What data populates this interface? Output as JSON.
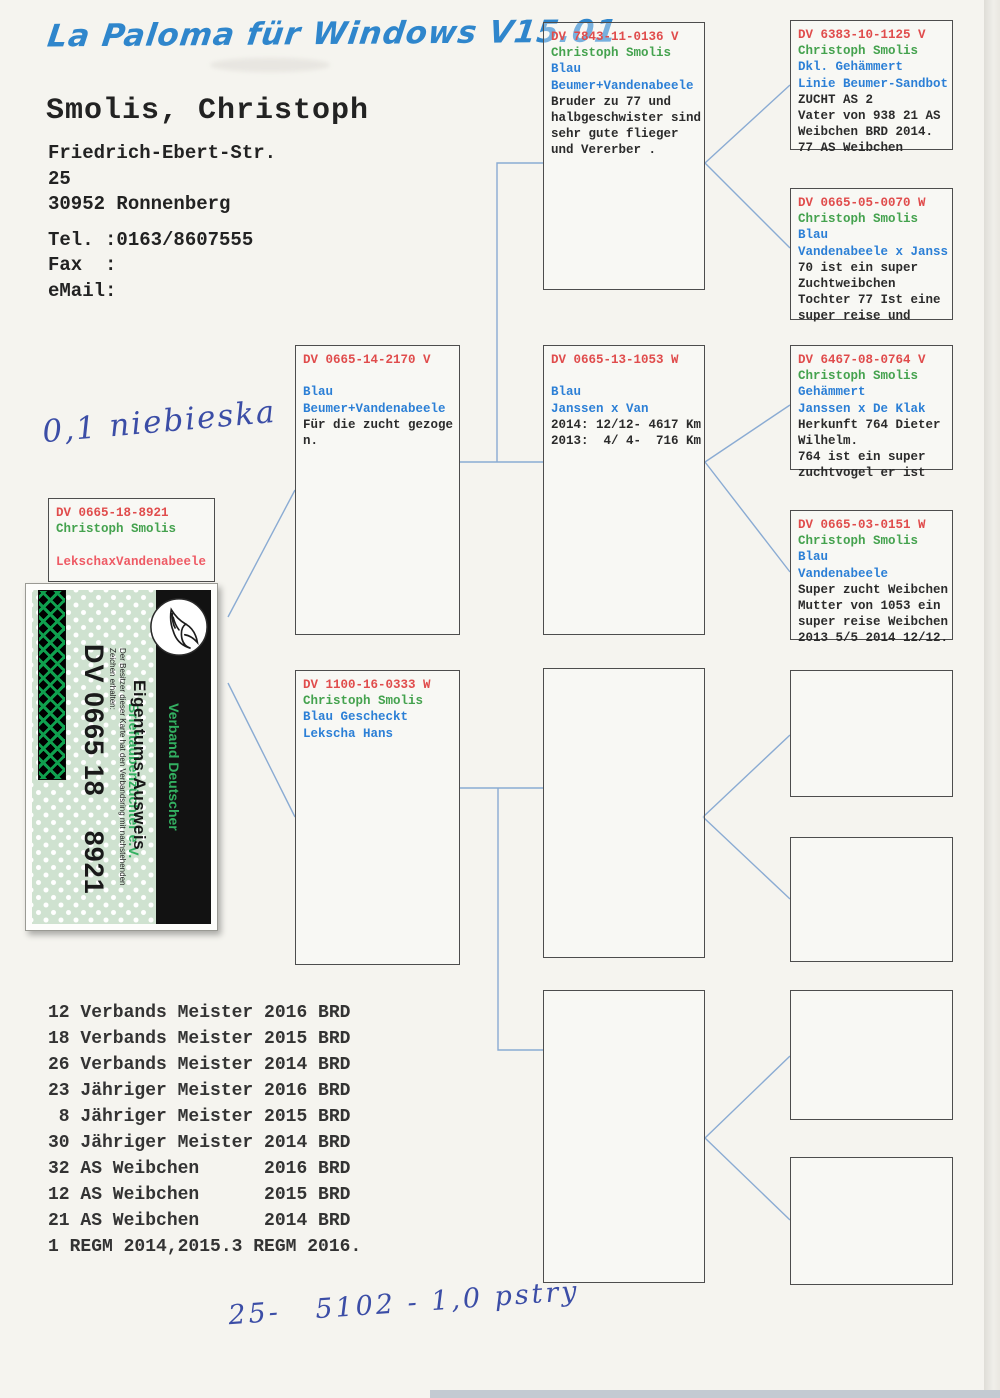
{
  "header": {
    "software": "La Paloma für Windows V15.01",
    "owner_name": "Smolis, Christoph",
    "address_lines": [
      "Friedrich-Ebert-Str.",
      "25",
      "30952 Ronnenberg"
    ],
    "contact_lines": [
      "Tel. :0163/8607555",
      "Fax  :",
      "eMail:"
    ]
  },
  "handwriting": {
    "top_note": "0,1 niebieska",
    "bottom_note": "25-   5102 - 1,0 pstry"
  },
  "subject": {
    "ring": "DV 0665-18-8921",
    "breeder": "Christoph Smolis",
    "strain": "LekschaxVandenabeele"
  },
  "card": {
    "org_line1": "Verband Deutscher",
    "org_line2": "Brieftaubenzüchter e.V.",
    "title": "Eigentums-Ausweis",
    "subtext": "Der Besitzer dieser Karte hat den Verbandsring mit nachstehenden Zeichen erhalten:",
    "ring_number": "DV 0665 18    8921",
    "logo_icon": "dove-logo"
  },
  "pedigree": {
    "boxes": [
      {
        "key": "sire",
        "ring": "DV 0665-14-2170 V",
        "breeder": "",
        "color_lines": [
          "Blau",
          "Beumer+Vandenabeele"
        ],
        "notes": [
          "Für die zucht gezoge",
          "n."
        ]
      },
      {
        "key": "dam",
        "ring": "DV 1100-16-0333 W",
        "breeder": "Christoph Smolis",
        "color_lines": [
          "Blau Gescheckt",
          "Lekscha Hans"
        ],
        "notes": []
      },
      {
        "key": "ss",
        "ring": "DV 7843-11-0136 V",
        "breeder": "Christoph Smolis",
        "color_lines": [
          "Blau",
          "Beumer+Vandenabeele"
        ],
        "notes": [
          "Bruder zu 77 und",
          "halbgeschwister sind",
          "sehr gute flieger",
          "und Vererber ."
        ]
      },
      {
        "key": "sd",
        "ring": "DV 0665-13-1053 W",
        "breeder": "",
        "color_lines": [
          "Blau",
          "Janssen x Van"
        ],
        "notes": [
          "2014: 12/12- 4617 Km",
          "2013:  4/ 4-  716 Km"
        ]
      },
      {
        "key": "ds"
      },
      {
        "key": "dd"
      },
      {
        "key": "sss",
        "ring": "DV 6383-10-1125 V",
        "breeder": "Christoph Smolis",
        "color_lines": [
          "Dkl. Gehämmert",
          "Linie Beumer-Sandbot"
        ],
        "notes": [
          "ZUCHT AS 2",
          "Vater von 938 21 AS",
          "Weibchen BRD 2014.",
          "77 AS Weibchen"
        ]
      },
      {
        "key": "ssd",
        "ring": "DV 0665-05-0070 W",
        "breeder": "Christoph Smolis",
        "color_lines": [
          "Blau",
          "Vandenabeele x Janss"
        ],
        "notes": [
          "70 ist ein super",
          "Zuchtweibchen",
          "Tochter 77 Ist eine",
          "super reise und"
        ]
      },
      {
        "key": "sds",
        "ring": "DV 6467-08-0764 V",
        "breeder": "Christoph Smolis",
        "color_lines": [
          "Gehämmert",
          "Janssen x De Klak"
        ],
        "notes": [
          "Herkunft 764 Dieter",
          "Wilhelm.",
          "764 ist ein super",
          "zuchtvogel er ist"
        ]
      },
      {
        "key": "sdd",
        "ring": "DV 0665-03-0151 W",
        "breeder": "Christoph Smolis",
        "color_lines": [
          "Blau",
          "Vandenabeele"
        ],
        "notes": [
          "Super zucht Weibchen",
          "Mutter von 1053 ein",
          "super reise Weibchen",
          "2013 5/5 2014 12/12."
        ]
      },
      {
        "key": "dss"
      },
      {
        "key": "dsd"
      },
      {
        "key": "dds"
      },
      {
        "key": "ddd"
      }
    ]
  },
  "achievements": [
    "12 Verbands Meister 2016 BRD",
    "18 Verbands Meister 2015 BRD",
    "26 Verbands Meister 2014 BRD",
    "23 Jähriger Meister 2016 BRD",
    " 8 Jähriger Meister 2015 BRD",
    "30 Jähriger Meister 2014 BRD",
    "32 AS Weibchen      2016 BRD",
    "12 AS Weibchen      2015 BRD",
    "21 AS Weibchen      2014 BRD",
    "1 REGM 2014,2015.3 REGM 2016."
  ],
  "colors": {
    "ring": "#e04c4c",
    "breeder": "#44a24e",
    "blue": "#2b7fd6",
    "note": "#2b2b2b",
    "strain": "#ee5a64",
    "connector": "#8aabd3",
    "script_blue": "#2f86cc",
    "card_green": "#33b061"
  }
}
